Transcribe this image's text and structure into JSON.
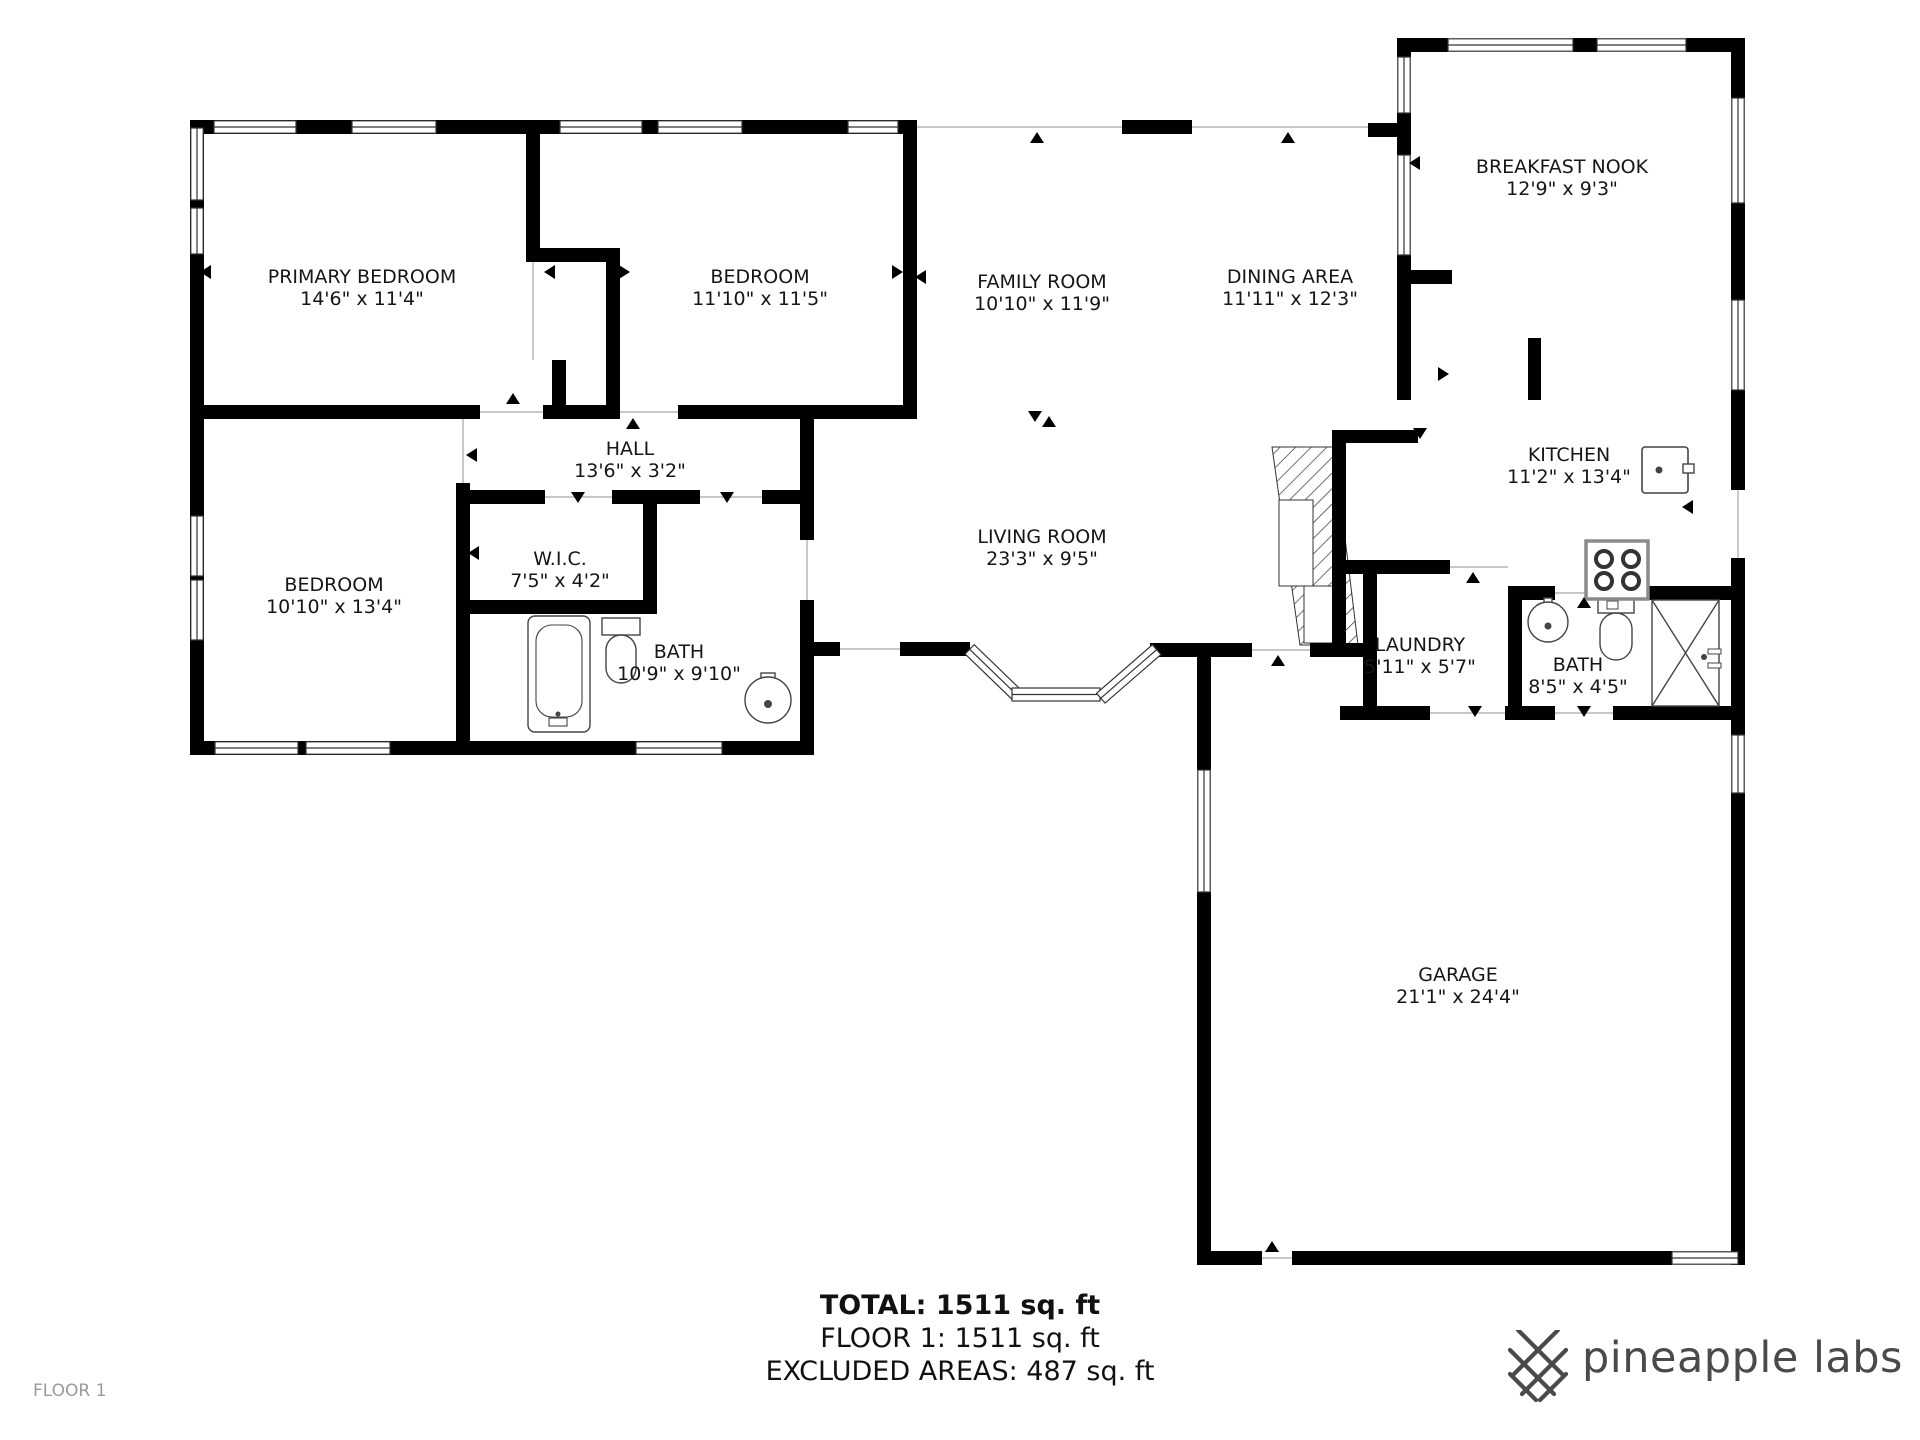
{
  "meta": {
    "floor_label": "FLOOR 1"
  },
  "rooms": [
    {
      "name": "PRIMARY BEDROOM",
      "dims": "14'6\" x 11'4\""
    },
    {
      "name": "BEDROOM",
      "dims": "11'10\" x 11'5\""
    },
    {
      "name": "FAMILY ROOM",
      "dims": "10'10\" x 11'9\""
    },
    {
      "name": "DINING AREA",
      "dims": "11'11\" x 12'3\""
    },
    {
      "name": "BREAKFAST NOOK",
      "dims": "12'9\" x 9'3\""
    },
    {
      "name": "HALL",
      "dims": "13'6\" x 3'2\""
    },
    {
      "name": "W.I.C.",
      "dims": "7'5\" x 4'2\""
    },
    {
      "name": "BEDROOM",
      "dims": "10'10\" x 13'4\""
    },
    {
      "name": "LIVING ROOM",
      "dims": "23'3\" x 9'5\""
    },
    {
      "name": "BATH",
      "dims": "10'9\" x 9'10\""
    },
    {
      "name": "KITCHEN",
      "dims": "11'2\" x 13'4\""
    },
    {
      "name": "LAUNDRY",
      "dims": "5'11\" x 5'7\""
    },
    {
      "name": "BATH",
      "dims": "8'5\" x 4'5\""
    },
    {
      "name": "GARAGE",
      "dims": "21'1\" x 24'4\""
    }
  ],
  "footer": {
    "total": "TOTAL: 1511 sq. ft",
    "floor": "FLOOR 1: 1511 sq. ft",
    "excluded": "EXCLUDED AREAS: 487 sq. ft"
  },
  "branding": {
    "logo_text": "pineapple labs",
    "logo_color": "#4a4a4a"
  },
  "colors": {
    "wall": "#000000",
    "open_line": "#b5b5bc",
    "fixture": "#444444"
  }
}
